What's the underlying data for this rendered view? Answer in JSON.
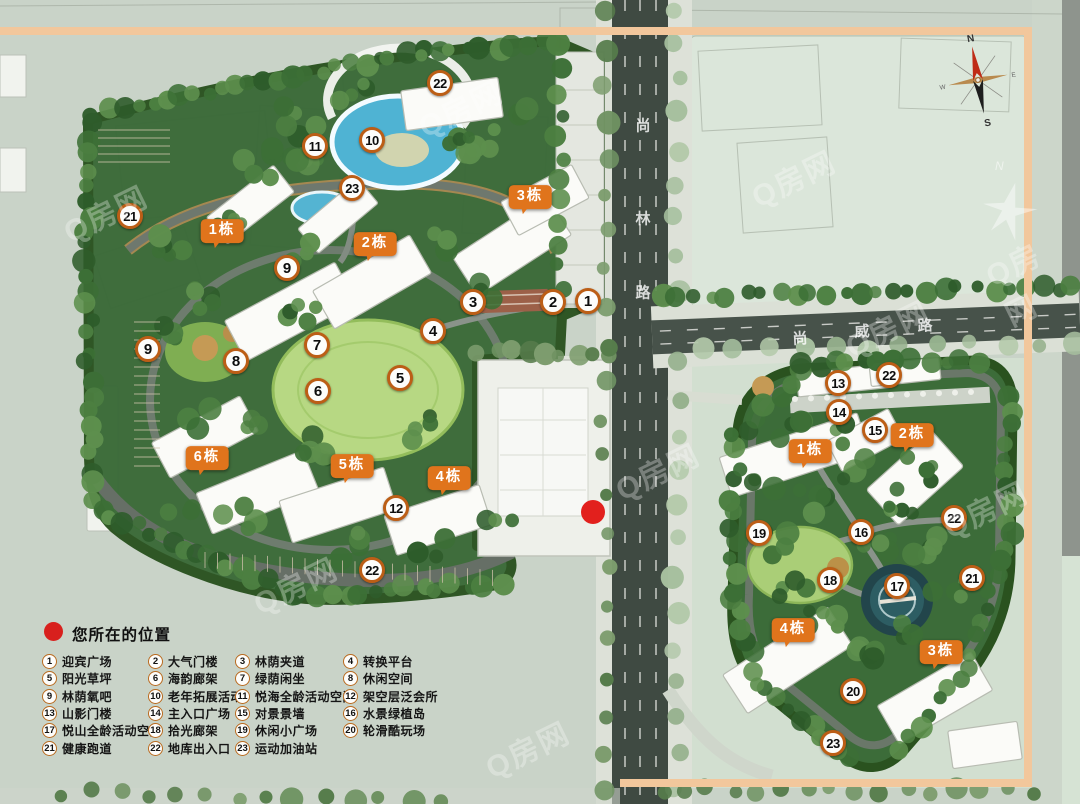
{
  "watermark": "Q房网",
  "roads": {
    "vertical": "尚林路",
    "horizontal": "尚威路"
  },
  "compass": {
    "n": "N",
    "s": "S",
    "e": "E",
    "w": "W"
  },
  "legend": {
    "title": "您所在的位置",
    "columns": [
      [
        {
          "num": "1",
          "label": "迎宾广场"
        },
        {
          "num": "5",
          "label": "阳光草坪"
        },
        {
          "num": "9",
          "label": "林荫氧吧"
        },
        {
          "num": "13",
          "label": "山影门楼"
        },
        {
          "num": "17",
          "label": "悦山全龄活动空间"
        },
        {
          "num": "21",
          "label": "健康跑道"
        }
      ],
      [
        {
          "num": "2",
          "label": "大气门楼"
        },
        {
          "num": "6",
          "label": "海韵廊架"
        },
        {
          "num": "10",
          "label": "老年拓展活动"
        },
        {
          "num": "14",
          "label": "主入口广场"
        },
        {
          "num": "18",
          "label": "拾光廊架"
        },
        {
          "num": "22",
          "label": "地库出入口"
        }
      ],
      [
        {
          "num": "3",
          "label": "林荫夹道"
        },
        {
          "num": "7",
          "label": "绿荫闲坐"
        },
        {
          "num": "11",
          "label": "悦海全龄活动空间"
        },
        {
          "num": "15",
          "label": "对景景墙"
        },
        {
          "num": "19",
          "label": "休闲小广场"
        },
        {
          "num": "23",
          "label": "运动加油站"
        }
      ],
      [
        {
          "num": "4",
          "label": "转换平台"
        },
        {
          "num": "8",
          "label": "休闲空间"
        },
        {
          "num": "12",
          "label": "架空层泛会所"
        },
        {
          "num": "16",
          "label": "水景绿植岛"
        },
        {
          "num": "20",
          "label": "轮滑酷玩场"
        }
      ]
    ]
  },
  "map_markers": {
    "left_site": [
      {
        "num": "22",
        "x": 440,
        "y": 83
      },
      {
        "num": "11",
        "x": 315,
        "y": 146
      },
      {
        "num": "10",
        "x": 372,
        "y": 140
      },
      {
        "num": "23",
        "x": 352,
        "y": 188
      },
      {
        "num": "21",
        "x": 130,
        "y": 216
      },
      {
        "num": "9",
        "x": 287,
        "y": 268
      },
      {
        "num": "3",
        "x": 473,
        "y": 302
      },
      {
        "num": "2",
        "x": 553,
        "y": 302
      },
      {
        "num": "1",
        "x": 588,
        "y": 301
      },
      {
        "num": "4",
        "x": 433,
        "y": 331
      },
      {
        "num": "9",
        "x": 148,
        "y": 349
      },
      {
        "num": "8",
        "x": 236,
        "y": 361
      },
      {
        "num": "7",
        "x": 317,
        "y": 345
      },
      {
        "num": "5",
        "x": 400,
        "y": 378
      },
      {
        "num": "6",
        "x": 318,
        "y": 391
      },
      {
        "num": "12",
        "x": 396,
        "y": 508
      },
      {
        "num": "22",
        "x": 372,
        "y": 570
      }
    ],
    "right_site": [
      {
        "num": "13",
        "x": 838,
        "y": 383
      },
      {
        "num": "22",
        "x": 889,
        "y": 375
      },
      {
        "num": "14",
        "x": 839,
        "y": 412
      },
      {
        "num": "15",
        "x": 875,
        "y": 430
      },
      {
        "num": "19",
        "x": 759,
        "y": 533
      },
      {
        "num": "16",
        "x": 861,
        "y": 532
      },
      {
        "num": "22",
        "x": 954,
        "y": 518
      },
      {
        "num": "18",
        "x": 830,
        "y": 580
      },
      {
        "num": "17",
        "x": 897,
        "y": 586
      },
      {
        "num": "21",
        "x": 972,
        "y": 578
      },
      {
        "num": "20",
        "x": 853,
        "y": 691
      },
      {
        "num": "23",
        "x": 833,
        "y": 743
      }
    ]
  },
  "building_badges": {
    "left_site": [
      {
        "label": "1栋",
        "x": 222,
        "y": 232
      },
      {
        "label": "2栋",
        "x": 375,
        "y": 245
      },
      {
        "label": "3栋",
        "x": 530,
        "y": 198
      },
      {
        "label": "6栋",
        "x": 207,
        "y": 459
      },
      {
        "label": "5栋",
        "x": 352,
        "y": 467
      },
      {
        "label": "4栋",
        "x": 449,
        "y": 479
      }
    ],
    "right_site": [
      {
        "label": "1栋",
        "x": 810,
        "y": 452
      },
      {
        "label": "2栋",
        "x": 912,
        "y": 436
      },
      {
        "label": "4栋",
        "x": 793,
        "y": 631
      },
      {
        "label": "3栋",
        "x": 941,
        "y": 653
      }
    ]
  },
  "location_dot": {
    "x": 593,
    "y": 512
  },
  "colors": {
    "badge_orange": "#e0741c",
    "marker_ring": "#bc5e16",
    "frame_orange": "#f2c79c",
    "location_red": "#e2201d",
    "site_green": "#3a6a37",
    "road_dark": "#3f4a42",
    "pool_blue": "#4fb3d3",
    "lawn_green": "#b7d883"
  }
}
